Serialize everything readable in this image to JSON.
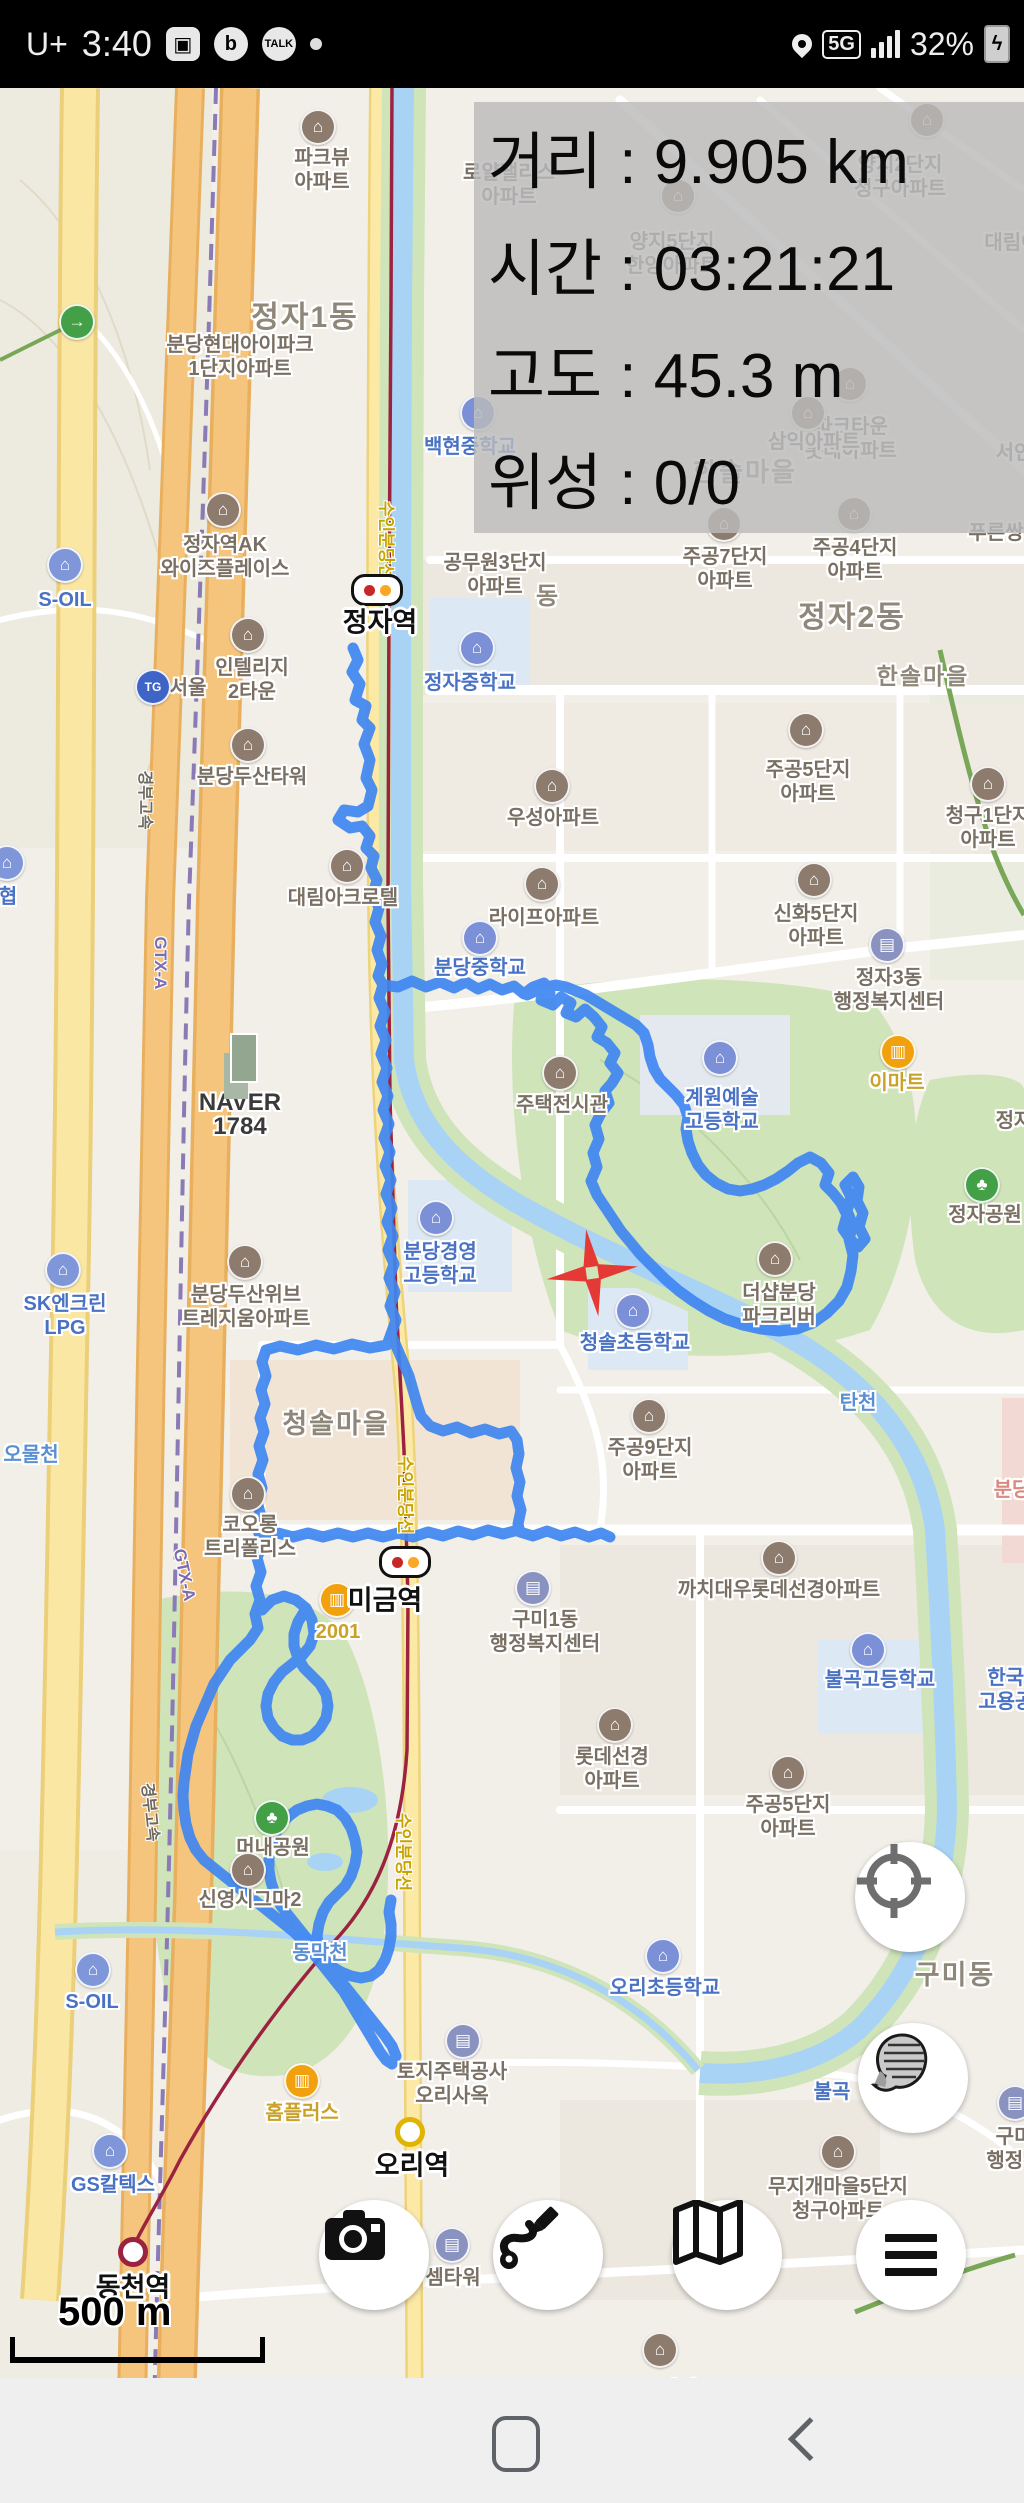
{
  "status_bar": {
    "carrier": "U+",
    "time": "3:40",
    "battery_pct": "32%",
    "network": "5G",
    "left_icons": [
      "gallery-icon",
      "band-icon",
      "kakaotalk-icon",
      "notification-dot"
    ],
    "right_icons": [
      "location-pin-icon",
      "5g-network-icon",
      "signal-bars-icon",
      "battery-charging-icon"
    ],
    "talk_label": "TALK",
    "band_label": "b"
  },
  "overlay": {
    "rows": [
      {
        "label": "거리",
        "value": "9.905 km"
      },
      {
        "label": "시간",
        "value": "03:21:21"
      },
      {
        "label": "고도",
        "value": "45.3 m"
      },
      {
        "label": "위성",
        "value": "0/0"
      }
    ]
  },
  "map": {
    "route_color": "#3f86f1",
    "districts": [
      {
        "x": 305,
        "y": 318,
        "t": "정자1동",
        "s": 30
      },
      {
        "x": 852,
        "y": 618,
        "t": "정자2동",
        "s": 30
      },
      {
        "x": 745,
        "y": 472,
        "t": "한솔마을",
        "s": 26
      },
      {
        "x": 923,
        "y": 676,
        "t": "한솔마을",
        "s": 23
      },
      {
        "x": 336,
        "y": 1424,
        "t": "청솔마을",
        "s": 27
      },
      {
        "x": 955,
        "y": 1975,
        "t": "구미동",
        "s": 27
      },
      {
        "x": 548,
        "y": 597,
        "t": "동",
        "s": 24
      }
    ],
    "pois": [
      {
        "t": "apt",
        "lines": [
          "파크뷰",
          "아파트"
        ],
        "x": 322,
        "y": 158,
        "ix": 318,
        "iy": 127
      },
      {
        "t": "apt",
        "lines": [
          "로얄팰리스",
          "아파트"
        ],
        "x": 509,
        "y": 173
      },
      {
        "t": "apt",
        "lines": [
          "양지5단지",
          "한양아파트"
        ],
        "x": 672,
        "y": 242,
        "ix": 678,
        "iy": 196
      },
      {
        "t": "apt",
        "lines": [
          "양지2단지",
          "청구아파트"
        ],
        "x": 900,
        "y": 165,
        "ix": 927,
        "iy": 120
      },
      {
        "t": "apt",
        "lines": [
          "대림아"
        ],
        "x": 1012,
        "y": 243
      },
      {
        "t": "apt",
        "lines": [
          "파크타운",
          "롯데아파트"
        ],
        "x": 851,
        "y": 427,
        "ix": 850,
        "iy": 384
      },
      {
        "t": "plain",
        "lines": [
          "서인"
        ],
        "x": 1014,
        "y": 453
      },
      {
        "t": "apt",
        "lines": [
          "삼익아파트"
        ],
        "x": 814,
        "y": 442,
        "ix": 808,
        "iy": 413
      },
      {
        "t": "apt",
        "lines": [
          "푸른쌍"
        ],
        "x": 996,
        "y": 533
      },
      {
        "t": "apt",
        "lines": [
          "분당현대아이파크",
          "1단지아파트"
        ],
        "x": 240,
        "y": 345
      },
      {
        "t": "sch",
        "lines": [
          "백현중학교"
        ],
        "x": 470,
        "y": 447,
        "ix": 478,
        "iy": 413
      },
      {
        "t": "apt",
        "lines": [
          "공무원3단지",
          "아파트"
        ],
        "x": 495,
        "y": 563
      },
      {
        "t": "apt",
        "lines": [
          "주공7단지",
          "아파트"
        ],
        "x": 725,
        "y": 557,
        "ix": 724,
        "iy": 524
      },
      {
        "t": "apt",
        "lines": [
          "주공4단지",
          "아파트"
        ],
        "x": 855,
        "y": 548,
        "ix": 854,
        "iy": 514
      },
      {
        "t": "apt",
        "lines": [
          "정자역AK",
          "와이즈플레이스"
        ],
        "x": 225,
        "y": 545,
        "ix": 223,
        "iy": 510
      },
      {
        "t": "gas",
        "lines": [
          "S-OIL"
        ],
        "x": 65,
        "y": 600,
        "ix": 65,
        "iy": 565
      },
      {
        "t": "tg",
        "lines": [
          "서울"
        ],
        "x": 188,
        "y": 688,
        "ix": 153,
        "iy": 687
      },
      {
        "t": "apt",
        "lines": [
          "인텔리지",
          "2타운"
        ],
        "x": 252,
        "y": 668,
        "ix": 248,
        "iy": 635
      },
      {
        "t": "sch",
        "lines": [
          "정자중학교"
        ],
        "x": 470,
        "y": 683,
        "ix": 477,
        "iy": 648
      },
      {
        "t": "apt",
        "lines": [
          "우성아파트"
        ],
        "x": 553,
        "y": 818,
        "ix": 552,
        "iy": 786
      },
      {
        "t": "apt",
        "lines": [
          "청구1단지",
          "아파트"
        ],
        "x": 988,
        "y": 816,
        "ix": 988,
        "iy": 784
      },
      {
        "t": "apt",
        "lines": [
          "분당두산타워"
        ],
        "x": 252,
        "y": 777,
        "ix": 248,
        "iy": 745
      },
      {
        "t": "gas",
        "lines": [
          "협"
        ],
        "x": 8,
        "y": 897,
        "ix": 7,
        "iy": 863
      },
      {
        "t": "apt",
        "lines": [
          "라이프아파트"
        ],
        "x": 544,
        "y": 918,
        "ix": 542,
        "iy": 884
      },
      {
        "t": "apt",
        "lines": [
          "신화5단지",
          "아파트"
        ],
        "x": 816,
        "y": 914,
        "ix": 814,
        "iy": 880
      },
      {
        "t": "apt",
        "lines": [
          "대림아크로텔"
        ],
        "x": 343,
        "y": 898,
        "ix": 347,
        "iy": 866
      },
      {
        "t": "sch",
        "lines": [
          "분당중학교"
        ],
        "x": 480,
        "y": 968,
        "ix": 480,
        "iy": 938
      },
      {
        "t": "gov",
        "lines": [
          "정자3동",
          "행정복지센터"
        ],
        "x": 889,
        "y": 978,
        "ix": 887,
        "iy": 945
      },
      {
        "t": "naver",
        "lines": [
          "NAVER",
          "1784"
        ],
        "x": 240,
        "y": 1103
      },
      {
        "t": "mart",
        "lines": [
          "이마트"
        ],
        "x": 897,
        "y": 1083,
        "ix": 898,
        "iy": 1052
      },
      {
        "t": "apt",
        "lines": [
          "주택전시관"
        ],
        "x": 562,
        "y": 1105,
        "ix": 560,
        "iy": 1073
      },
      {
        "t": "sch",
        "lines": [
          "계원예술",
          "고등학교"
        ],
        "x": 722,
        "y": 1098,
        "ix": 720,
        "iy": 1058
      },
      {
        "t": "park",
        "lines": [
          "정자공원"
        ],
        "x": 985,
        "y": 1215,
        "ix": 982,
        "iy": 1185
      },
      {
        "t": "plain",
        "lines": [
          "정자"
        ],
        "x": 1014,
        "y": 1121
      },
      {
        "t": "apt",
        "lines": [
          "더샵분당",
          "파크리버"
        ],
        "x": 779,
        "y": 1293,
        "ix": 775,
        "iy": 1259
      },
      {
        "t": "apt",
        "lines": [
          "분당두산위브",
          "트레지움아파트"
        ],
        "x": 246,
        "y": 1295,
        "ix": 245,
        "iy": 1262
      },
      {
        "t": "gas",
        "lines": [
          "SK엔크린",
          "LPG"
        ],
        "x": 65,
        "y": 1304,
        "ix": 63,
        "iy": 1270
      },
      {
        "t": "sch",
        "lines": [
          "분당경영",
          "고등학교"
        ],
        "x": 440,
        "y": 1252,
        "ix": 436,
        "iy": 1218
      },
      {
        "t": "sch",
        "lines": [
          "청솔초등학교"
        ],
        "x": 635,
        "y": 1343,
        "ix": 633,
        "iy": 1311
      },
      {
        "t": "water",
        "lines": [
          "오물천"
        ],
        "x": 31,
        "y": 1455
      },
      {
        "t": "water",
        "lines": [
          "탄천"
        ],
        "x": 858,
        "y": 1403
      },
      {
        "t": "apt",
        "lines": [
          "주공9단지",
          "아파트"
        ],
        "x": 650,
        "y": 1448,
        "ix": 649,
        "iy": 1416
      },
      {
        "t": "apt",
        "lines": [
          "코오롱",
          "트리폴리스"
        ],
        "x": 250,
        "y": 1525,
        "ix": 248,
        "iy": 1494
      },
      {
        "t": "mart",
        "lines": [
          "2001"
        ],
        "x": 338,
        "y": 1632,
        "ix": 337,
        "iy": 1600
      },
      {
        "t": "gov",
        "lines": [
          "구미1동",
          "행정복지센터"
        ],
        "x": 545,
        "y": 1620,
        "ix": 533,
        "iy": 1588
      },
      {
        "t": "apt",
        "lines": [
          "까치대우롯데선경아파트"
        ],
        "x": 779,
        "y": 1590,
        "ix": 779,
        "iy": 1558
      },
      {
        "t": "sch",
        "lines": [
          "불곡고등학교"
        ],
        "x": 880,
        "y": 1680,
        "ix": 868,
        "iy": 1650
      },
      {
        "t": "sch",
        "lines": [
          "한국장",
          "고용공단"
        ],
        "x": 1015,
        "y": 1678
      },
      {
        "t": "pink",
        "lines": [
          "분당"
        ],
        "x": 1012,
        "y": 1490
      },
      {
        "t": "apt",
        "lines": [
          "롯데선경",
          "아파트"
        ],
        "x": 612,
        "y": 1757,
        "ix": 615,
        "iy": 1725
      },
      {
        "t": "apt",
        "lines": [
          "주공5단지",
          "아파트"
        ],
        "x": 808,
        "y": 770,
        "ix": 806,
        "iy": 730
      },
      {
        "t": "apt",
        "lines": [
          "주공5단지",
          "아파트"
        ],
        "x": 788,
        "y": 1805,
        "ix": 788,
        "iy": 1773
      },
      {
        "t": "park",
        "lines": [
          "머내공원"
        ],
        "x": 273,
        "y": 1848,
        "ix": 272,
        "iy": 1818
      },
      {
        "t": "apt",
        "lines": [
          "신영시그마2"
        ],
        "x": 250,
        "y": 1900,
        "ix": 248,
        "iy": 1870
      },
      {
        "t": "water",
        "lines": [
          "동막천"
        ],
        "x": 320,
        "y": 1953
      },
      {
        "t": "gas",
        "lines": [
          "S-OIL"
        ],
        "x": 92,
        "y": 2002,
        "ix": 93,
        "iy": 1970
      },
      {
        "t": "sch",
        "lines": [
          "오리초등학교"
        ],
        "x": 665,
        "y": 1988,
        "ix": 663,
        "iy": 1956
      },
      {
        "t": "gov",
        "lines": [
          "토지주택공사",
          "오리사옥"
        ],
        "x": 452,
        "y": 2072,
        "ix": 463,
        "iy": 2041
      },
      {
        "t": "mart",
        "lines": [
          "홈플러스"
        ],
        "x": 302,
        "y": 2113,
        "ix": 302,
        "iy": 2081
      },
      {
        "t": "gas",
        "lines": [
          "GS칼텍스"
        ],
        "x": 113,
        "y": 2185,
        "ix": 110,
        "iy": 2151
      },
      {
        "t": "sch",
        "lines": [
          "불곡"
        ],
        "x": 832,
        "y": 2092
      },
      {
        "t": "apt",
        "lines": [
          "무지개마을5단지",
          "청구아파트"
        ],
        "x": 838,
        "y": 2187,
        "ix": 838,
        "iy": 2152
      },
      {
        "t": "gov",
        "lines": [
          "구미",
          "행정복"
        ],
        "x": 1014,
        "y": 2137,
        "ix": 1015,
        "iy": 2103
      },
      {
        "t": "apt",
        "lines": [
          "LG2단지",
          "아파트"
        ],
        "x": 659,
        "y": 2390,
        "ix": 660,
        "iy": 2350
      },
      {
        "t": "gov",
        "lines": [
          "셈타워"
        ],
        "x": 453,
        "y": 2278,
        "ix": 452,
        "iy": 2245
      },
      {
        "t": "way",
        "lines": [],
        "x": 77,
        "y": 322
      }
    ],
    "stations": [
      {
        "x": 377,
        "y": 590,
        "kind": "pill",
        "name": "정자역",
        "tx": 380,
        "ty": 620
      },
      {
        "x": 405,
        "y": 1562,
        "kind": "pill",
        "name": "미금역",
        "tx": 385,
        "ty": 1598
      },
      {
        "x": 410,
        "y": 2132,
        "kind": "yellow",
        "name": "오리역",
        "tx": 412,
        "ty": 2163
      },
      {
        "x": 133,
        "y": 2252,
        "kind": "red",
        "name": "동천역",
        "tx": 133,
        "ty": 2285
      }
    ],
    "vlabels": [
      {
        "x": 388,
        "y": 540,
        "t": "수인분당선",
        "c": "#c8a400",
        "rot": 90,
        "s": 17
      },
      {
        "x": 407,
        "y": 1495,
        "t": "수인분당선",
        "c": "#c8a400",
        "rot": 90,
        "s": 17
      },
      {
        "x": 405,
        "y": 1852,
        "t": "수인분당선",
        "c": "#c8a400",
        "rot": 90,
        "s": 17
      },
      {
        "x": 147,
        "y": 800,
        "t": "경부고속",
        "c": "#6f6a5f",
        "rot": 90,
        "s": 16
      },
      {
        "x": 152,
        "y": 1812,
        "t": "경부고속",
        "c": "#6f6a5f",
        "rot": 84,
        "s": 16
      },
      {
        "x": 160,
        "y": 963,
        "t": "GTX-A",
        "c": "#7b6bb0",
        "rot": 90,
        "s": 17
      },
      {
        "x": 184,
        "y": 1575,
        "t": "GTX-A",
        "c": "#7b6bb0",
        "rot": 78,
        "s": 17
      }
    ],
    "scale_text": "500 m"
  },
  "controls": {
    "gps_button": "gps-target-icon",
    "layers_button": "map-layers-icon",
    "camera_button": "camera-icon",
    "route_button": "route-draw-icon",
    "mapview_button": "folded-map-icon",
    "menu_button": "hamburger-menu-icon"
  },
  "navbar": {
    "home": "home-button",
    "back": "back-button"
  }
}
